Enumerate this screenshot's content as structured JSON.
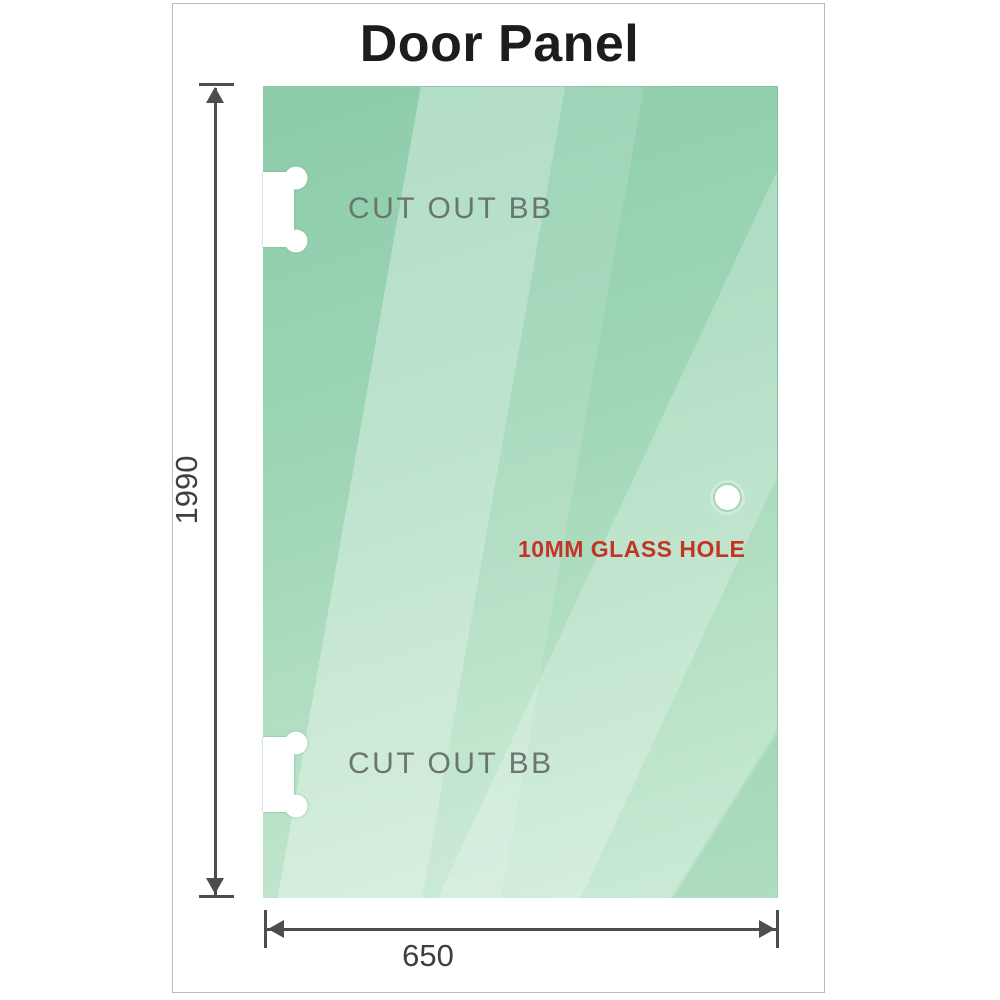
{
  "title": "Door Panel",
  "dimensions": {
    "height_mm": "1990",
    "width_mm": "650"
  },
  "annotations": {
    "cutout_top": "CUT OUT BB",
    "cutout_bottom": "CUT OUT BB",
    "glass_hole": "10MM GLASS HOLE"
  },
  "colors": {
    "glass_green": "#8cccaa",
    "glass_green_light": "#cdebd8",
    "dimension_line_gray": "#4d4d4d",
    "dimension_text_gray": "#3f3f3f",
    "cutout_label_gray": "#6b756f",
    "glass_hole_label_red": "#c43425",
    "title_black": "#1c1c1c",
    "frame_border_gray": "#b9b9b9"
  }
}
